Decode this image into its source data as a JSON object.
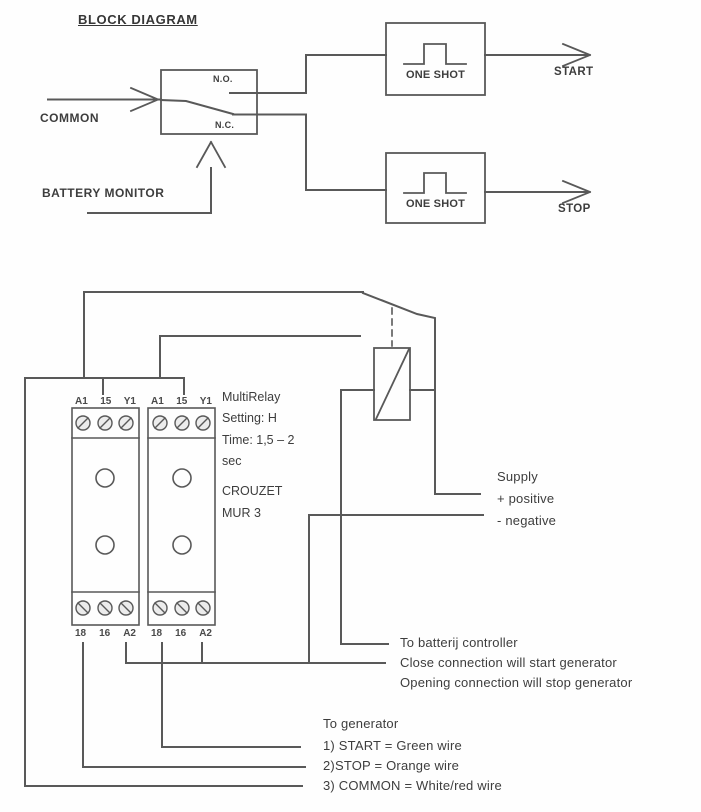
{
  "block_diagram": {
    "title": "BLOCK DIAGRAM",
    "relay_box": {
      "no_label": "N.O.",
      "nc_label": "N.C."
    },
    "inputs": {
      "common": "COMMON",
      "battery_monitor": "BATTERY MONITOR"
    },
    "one_shot_start": "ONE SHOT",
    "one_shot_stop": "ONE SHOT",
    "outputs": {
      "start": "START",
      "stop": "STOP"
    }
  },
  "wiring_diagram": {
    "modules": [
      {
        "top_terminals": [
          "A1",
          "15",
          "Y1"
        ],
        "bottom_terminals": [
          "18",
          "16",
          "A2"
        ]
      },
      {
        "top_terminals": [
          "A1",
          "15",
          "Y1"
        ],
        "bottom_terminals": [
          "18",
          "16",
          "A2"
        ]
      }
    ],
    "module_info": [
      "MultiRelay",
      "Setting: H",
      "Time: 1,5 – 2",
      "sec",
      "CROUZET",
      "MUR 3"
    ],
    "supply": {
      "line1": "Supply",
      "line2": "+ positive",
      "line3": "- negative"
    },
    "battery_controller": {
      "line1": "To batterij controller",
      "line2": "Close connection will start generator",
      "line3": "Opening connection will stop generator"
    },
    "generator": {
      "line1": "To generator",
      "line2": "1) START = Green wire",
      "line3": "2)STOP = Orange wire",
      "line4": "3) COMMON = White/red wire"
    }
  },
  "colors": {
    "line": "#595959",
    "text": "#3d3d3d"
  }
}
